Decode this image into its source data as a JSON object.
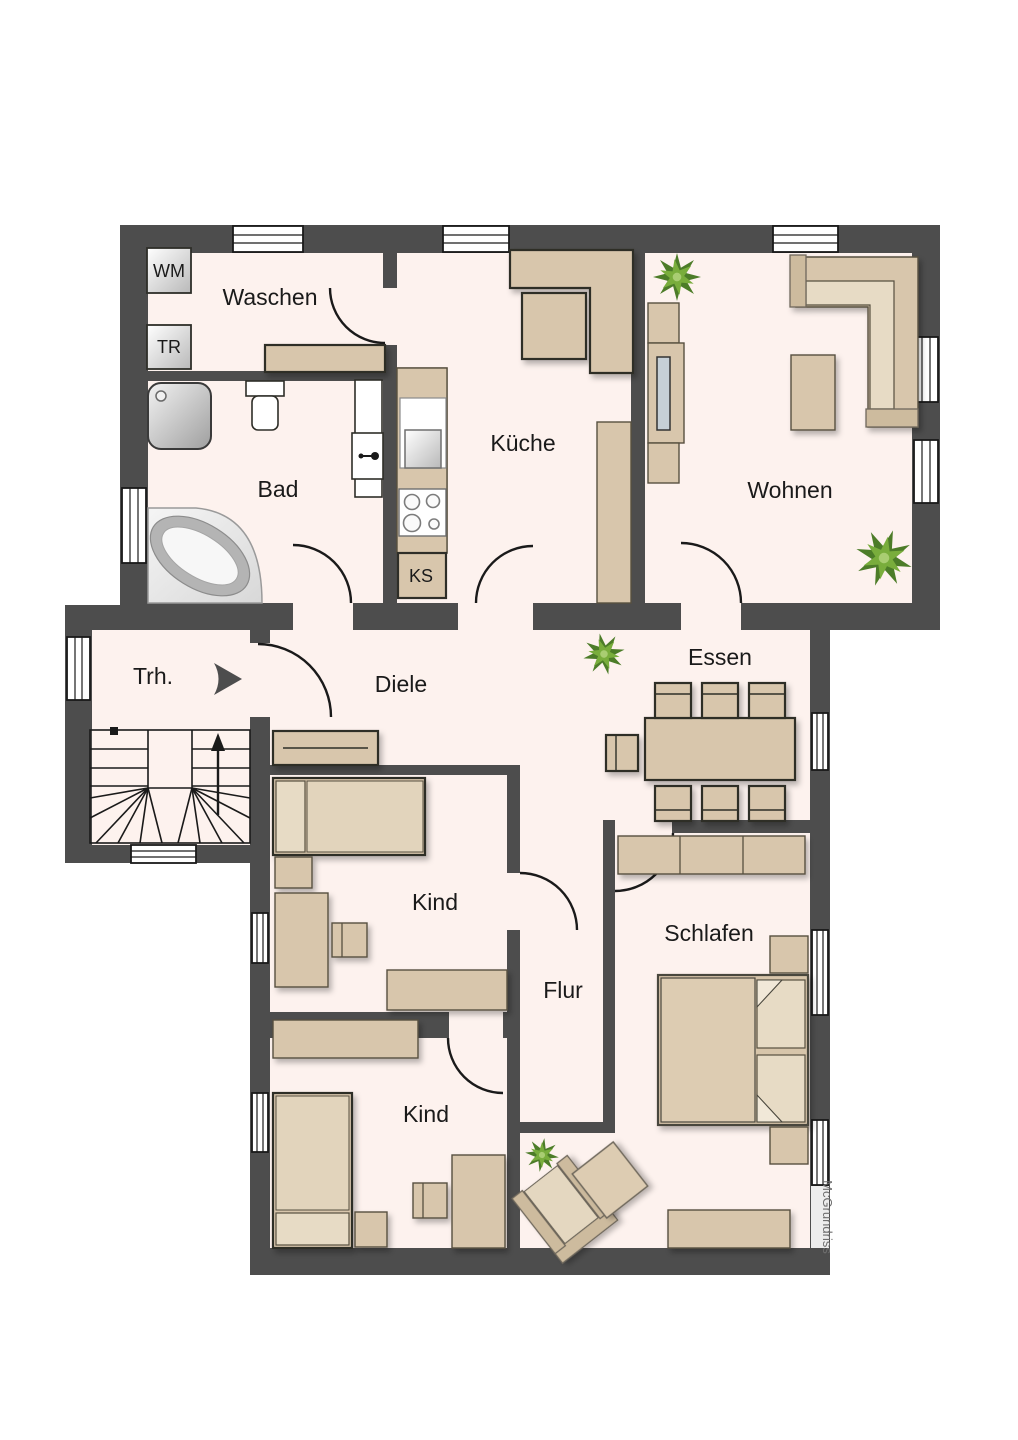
{
  "labels": {
    "waschen": "Waschen",
    "bad": "Bad",
    "kueche": "Küche",
    "wohnen": "Wohnen",
    "trh": "Trh.",
    "diele": "Diele",
    "essen": "Essen",
    "kind_1": "Kind",
    "kind_2": "Kind",
    "flur": "Flur",
    "schlafen": "Schlafen"
  },
  "appliances": {
    "washing_machine": "WM",
    "dryer": "TR",
    "fridge": "KS"
  },
  "watermark": "McGrundriss",
  "colors": {
    "wall": "#4d4d4d",
    "floor": "#fdf2ee",
    "furniture": "#d8c6ac",
    "furniture_light": "#e7dbc5",
    "plant_dark": "#4c7c28",
    "plant_mid": "#79ad3c",
    "plant_light": "#a9cd72"
  }
}
